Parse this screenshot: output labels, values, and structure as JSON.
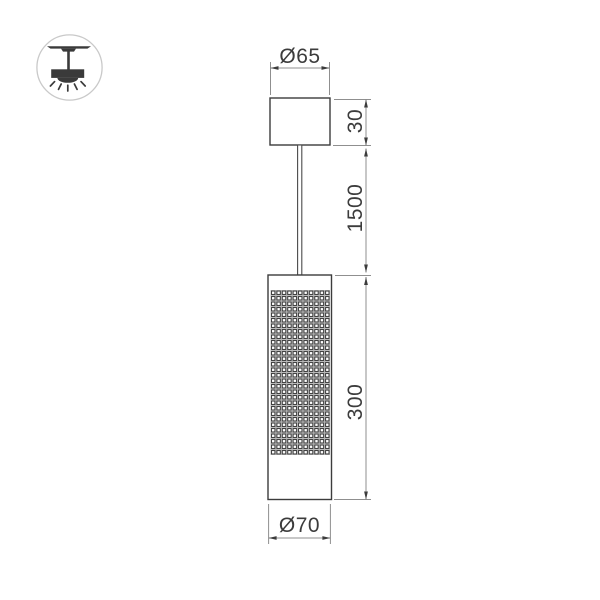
{
  "badge": {
    "icon": "ceiling-pendant-light-icon"
  },
  "drawing": {
    "kind": "pendant-lamp-dimension-drawing",
    "dimensions": {
      "canopy_diameter": "Ø65",
      "canopy_height": "30",
      "suspension_length": "1500",
      "body_height": "300",
      "body_diameter": "Ø70"
    },
    "colors": {
      "outline": "#3c3c3c",
      "dimension_line": "#8f8f8f",
      "arrow": "#3c3c3c",
      "text": "#3c3c3c",
      "mesh_gap": "#b9b9b9",
      "badge_border": "#c9c9c9"
    }
  }
}
